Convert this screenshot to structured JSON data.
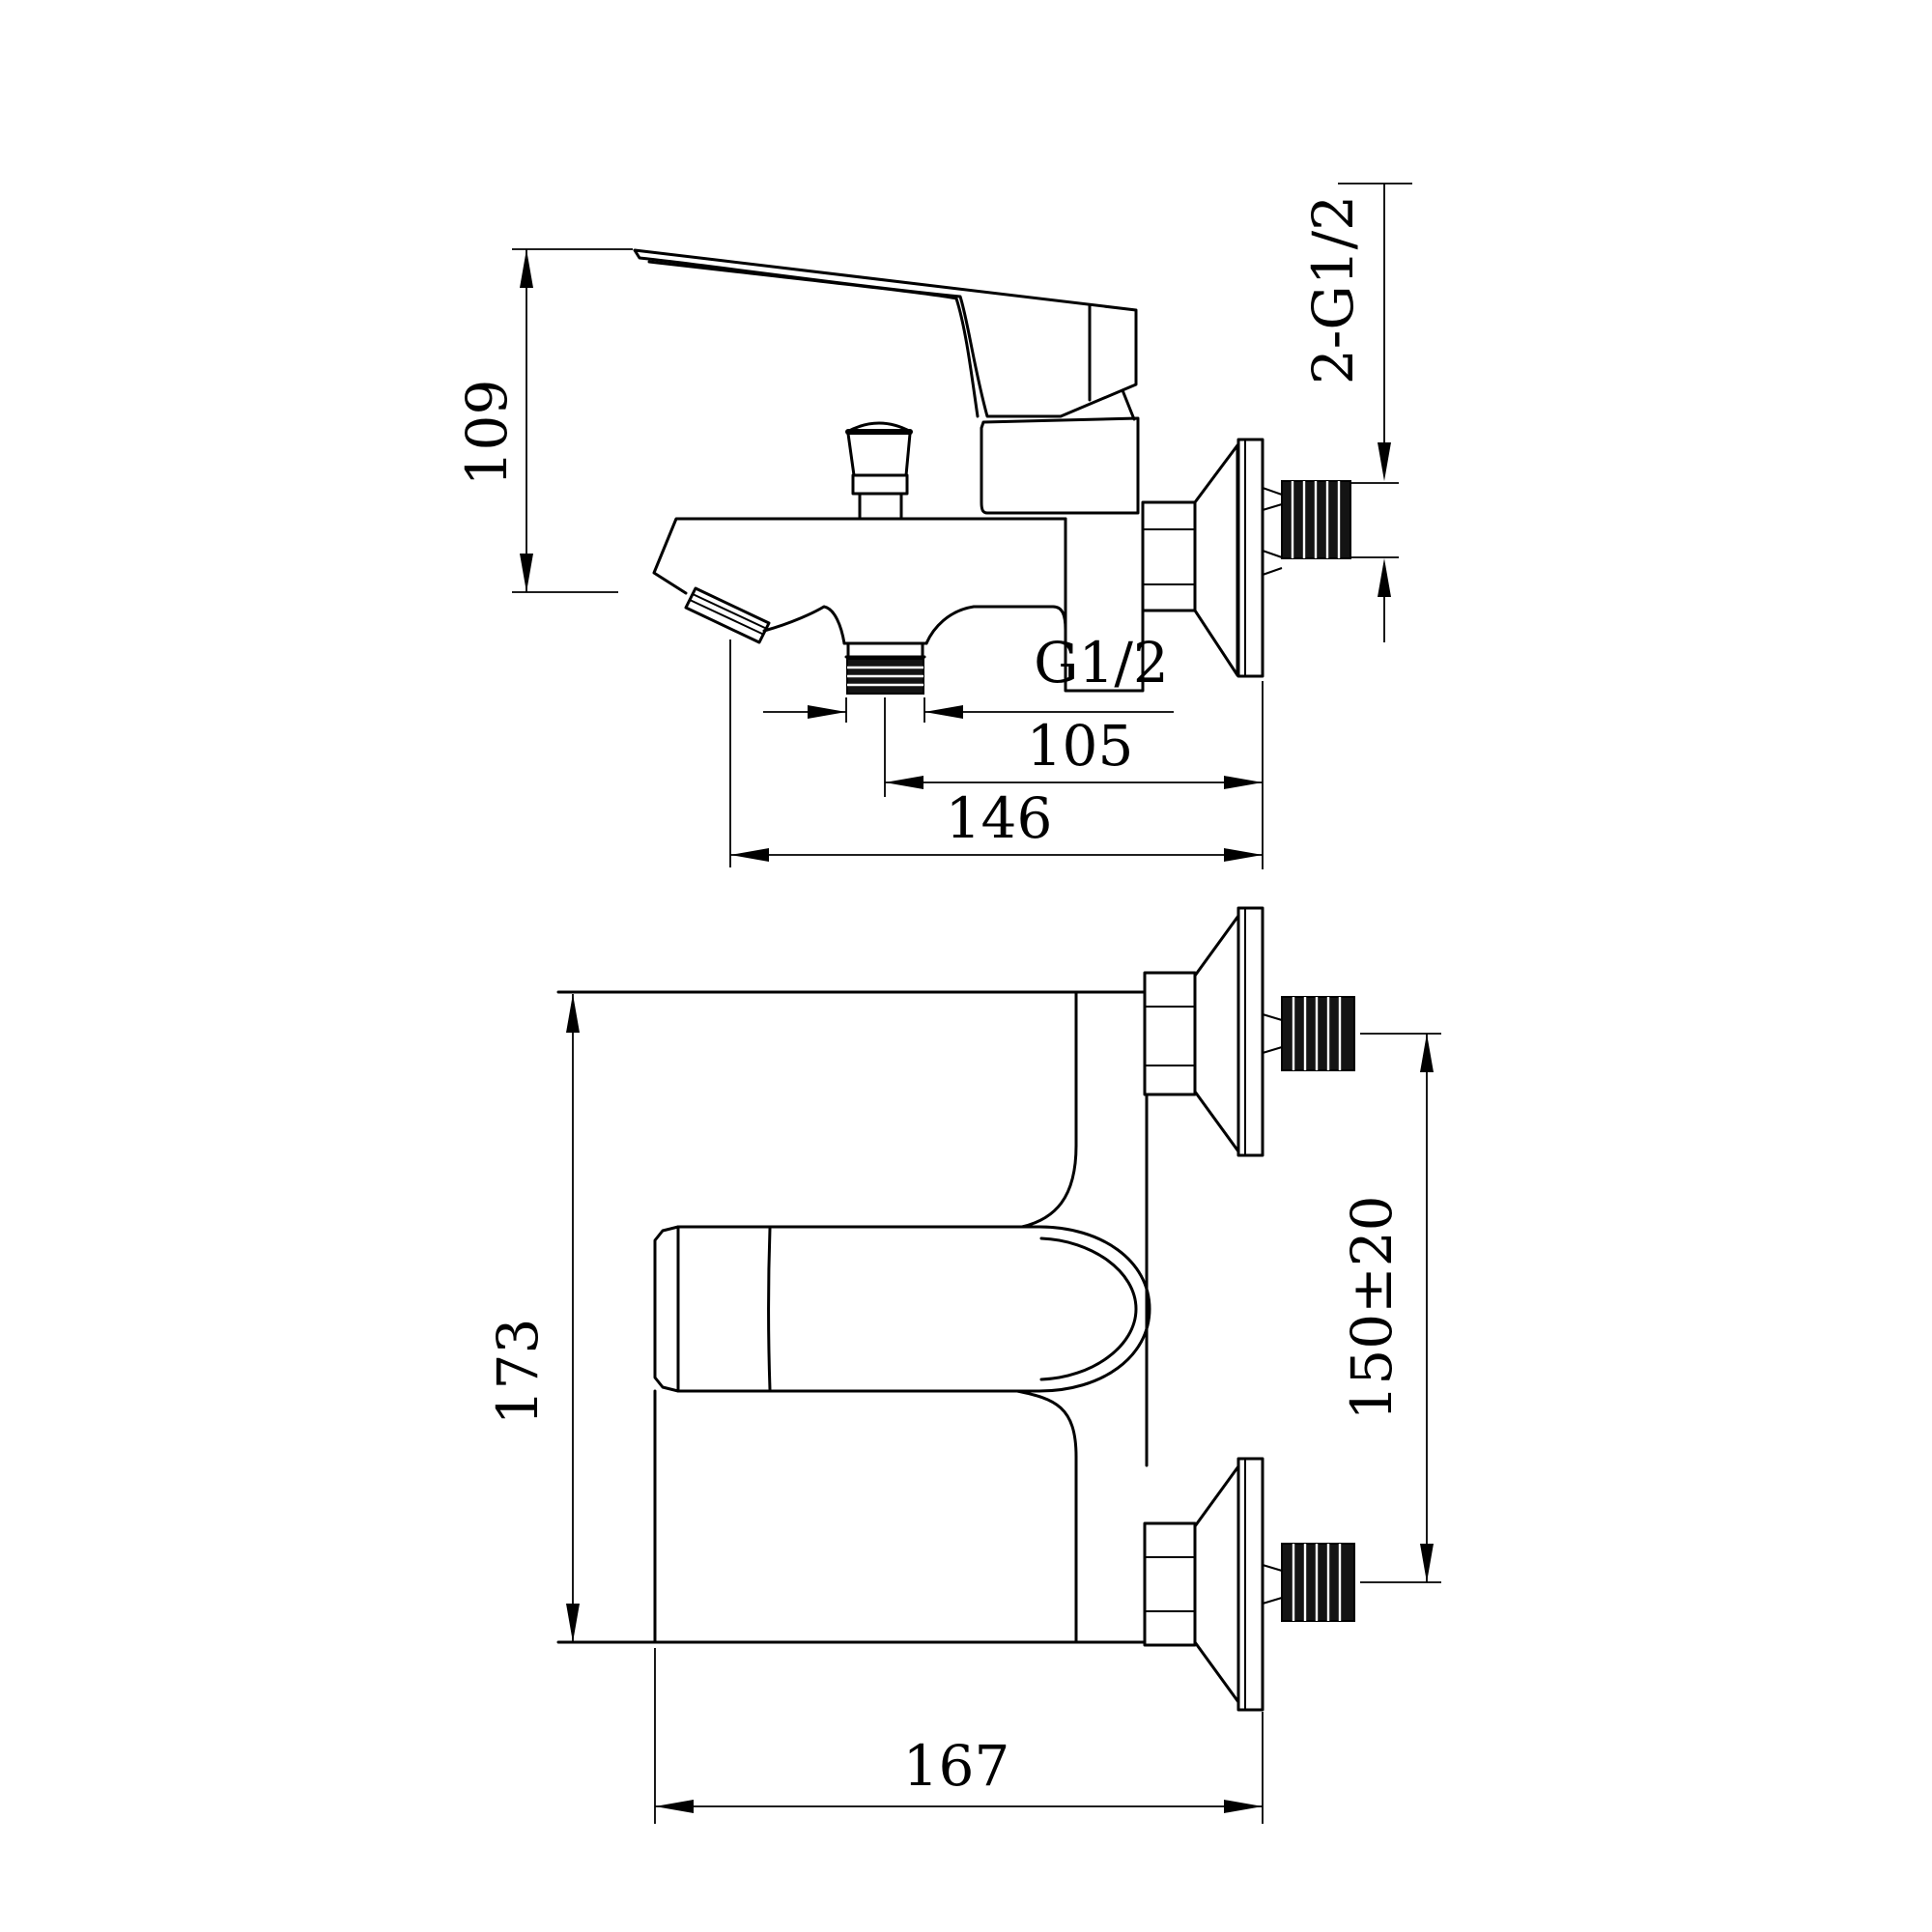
{
  "document": {
    "type": "technical dimension drawing",
    "subject": "wall-mounted single-lever bath/shower mixer faucet, side view and plan view"
  },
  "dims": {
    "total_height": "109",
    "wall_threads": "2-G1/2",
    "outlet_thread": "G1/2",
    "outlet_to_wall": "105",
    "spout_reach": "146",
    "body_width": "173",
    "inlet_spacing": "150±20",
    "total_depth": "167"
  }
}
